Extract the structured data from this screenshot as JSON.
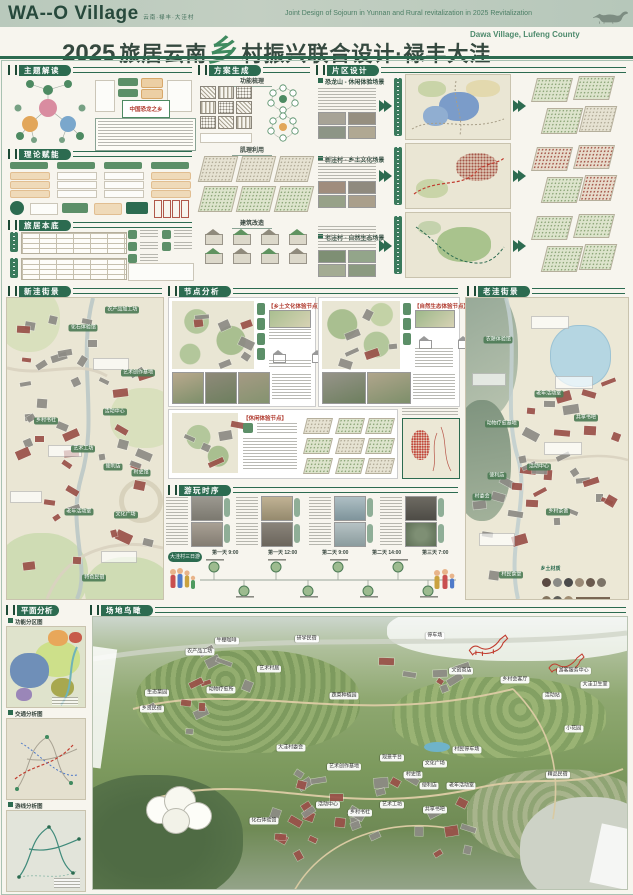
{
  "header": {
    "logo": "WA--O Village",
    "logo_sub": "云南·禄丰·大洼村",
    "en_line1": "Joint Design of Sojourn in Yunnan and Rural revitalization in 2025  Revitalization",
    "en_line2": "Dawa Village, Lufeng County",
    "title_year": "2025",
    "title_a": "旅居云南",
    "title_accent": "乡",
    "title_b": "村振兴联合设计·禄丰大洼",
    "title_en": "Dawa Village, Lufeng County"
  },
  "sections": {
    "theme": "主题解读",
    "theory": "理论赋能",
    "base": "旅居本底",
    "scheme": "方案生成",
    "district": "片区设计",
    "new_street": "新洼街景",
    "node": "节点分析",
    "old_street": "老洼街景",
    "timeline": "游玩时序",
    "plan": "平面分析",
    "aerial": "场地鸟瞰"
  },
  "theme": {
    "highlight": "中国恐龙之乡"
  },
  "scheme": {
    "sub1": "功能梳理",
    "sub2": "肌理利用",
    "sub3": "建筑改造"
  },
  "district": {
    "rows": [
      {
        "title": "恐龙山 - 休闲体验场景"
      },
      {
        "title": "新洼村 - 乡土文化场景"
      },
      {
        "title": "老洼村 - 自然生态场景"
      }
    ]
  },
  "node": {
    "panel1": "【乡土文化体验节点】",
    "panel2": "【自然生态体验节点】",
    "panel3": "【休闲体验节点】"
  },
  "timeline": {
    "route_label": "大洼村三日游",
    "times": [
      "第一天 9:00",
      "第一天 12:00",
      "第二天 9:00",
      "第二天 14:00",
      "第三天 7:00"
    ]
  },
  "plan": {
    "map1": "功能分区图",
    "map2": "交通分析图",
    "map3": "游线分析图"
  },
  "old_street": {
    "material_title": "乡土材质"
  },
  "new_street_labels": [
    {
      "t": "农产品加工坊",
      "x": 74,
      "y": 4
    },
    {
      "t": "化石体验馆",
      "x": 49,
      "y": 10
    },
    {
      "t": "艺术创作基地",
      "x": 84,
      "y": 25
    },
    {
      "t": "乡村书社",
      "x": 25,
      "y": 41
    },
    {
      "t": "活动中心",
      "x": 69,
      "y": 38
    },
    {
      "t": "艺术工坊",
      "x": 49,
      "y": 50
    },
    {
      "t": "便利店",
      "x": 68,
      "y": 56
    },
    {
      "t": "村史馆",
      "x": 86,
      "y": 58
    },
    {
      "t": "老年活动室",
      "x": 46,
      "y": 71
    },
    {
      "t": "文化广场",
      "x": 76,
      "y": 72
    },
    {
      "t": "特色民宿",
      "x": 56,
      "y": 93
    }
  ],
  "old_street_labels": [
    {
      "t": "农耕体验馆",
      "x": 20,
      "y": 14
    },
    {
      "t": "老年活动室",
      "x": 51,
      "y": 32
    },
    {
      "t": "共享书吧",
      "x": 74,
      "y": 40
    },
    {
      "t": "动物疗愈基地",
      "x": 22,
      "y": 42
    },
    {
      "t": "活动中心",
      "x": 45,
      "y": 56
    },
    {
      "t": "便利店",
      "x": 19,
      "y": 59
    },
    {
      "t": "村委会",
      "x": 10,
      "y": 66
    },
    {
      "t": "乡村茶舍",
      "x": 57,
      "y": 71
    },
    {
      "t": "村民食堂",
      "x": 28,
      "y": 92
    }
  ],
  "aerial_labels": [
    {
      "t": "农产品工坊",
      "x": 20,
      "y": 13
    },
    {
      "t": "牛棚咖啡",
      "x": 25,
      "y": 9
    },
    {
      "t": "研学民宿",
      "x": 40,
      "y": 8
    },
    {
      "t": "艺术村居",
      "x": 33,
      "y": 19
    },
    {
      "t": "生态菜园",
      "x": 12,
      "y": 28
    },
    {
      "t": "动物疗愈所",
      "x": 24,
      "y": 27
    },
    {
      "t": "乡贤民宿",
      "x": 11,
      "y": 34
    },
    {
      "t": "蔬菜种植园",
      "x": 47,
      "y": 29
    },
    {
      "t": "停车场",
      "x": 64,
      "y": 7
    },
    {
      "t": "文创商店",
      "x": 69,
      "y": 20
    },
    {
      "t": "乡村会客厅",
      "x": 79,
      "y": 23
    },
    {
      "t": "游客服务中心",
      "x": 90,
      "y": 20
    },
    {
      "t": "大洼卫生室",
      "x": 94,
      "y": 25
    },
    {
      "t": "活动站",
      "x": 86,
      "y": 29
    },
    {
      "t": "小花园",
      "x": 90,
      "y": 41
    },
    {
      "t": "大洼村委会",
      "x": 37,
      "y": 48
    },
    {
      "t": "观景平台",
      "x": 56,
      "y": 52
    },
    {
      "t": "村民停车场",
      "x": 70,
      "y": 49
    },
    {
      "t": "文化广场",
      "x": 64,
      "y": 54
    },
    {
      "t": "村史馆",
      "x": 60,
      "y": 58
    },
    {
      "t": "便利店",
      "x": 63,
      "y": 62
    },
    {
      "t": "老年活动室",
      "x": 69,
      "y": 62
    },
    {
      "t": "精品民宿",
      "x": 87,
      "y": 58
    },
    {
      "t": "艺术创作基地",
      "x": 47,
      "y": 55
    },
    {
      "t": "活动中心",
      "x": 44,
      "y": 69
    },
    {
      "t": "艺术工坊",
      "x": 56,
      "y": 69
    },
    {
      "t": "乡村书社",
      "x": 50,
      "y": 72
    },
    {
      "t": "共享书吧",
      "x": 64,
      "y": 71
    },
    {
      "t": "化石体验馆",
      "x": 32,
      "y": 75
    }
  ]
}
